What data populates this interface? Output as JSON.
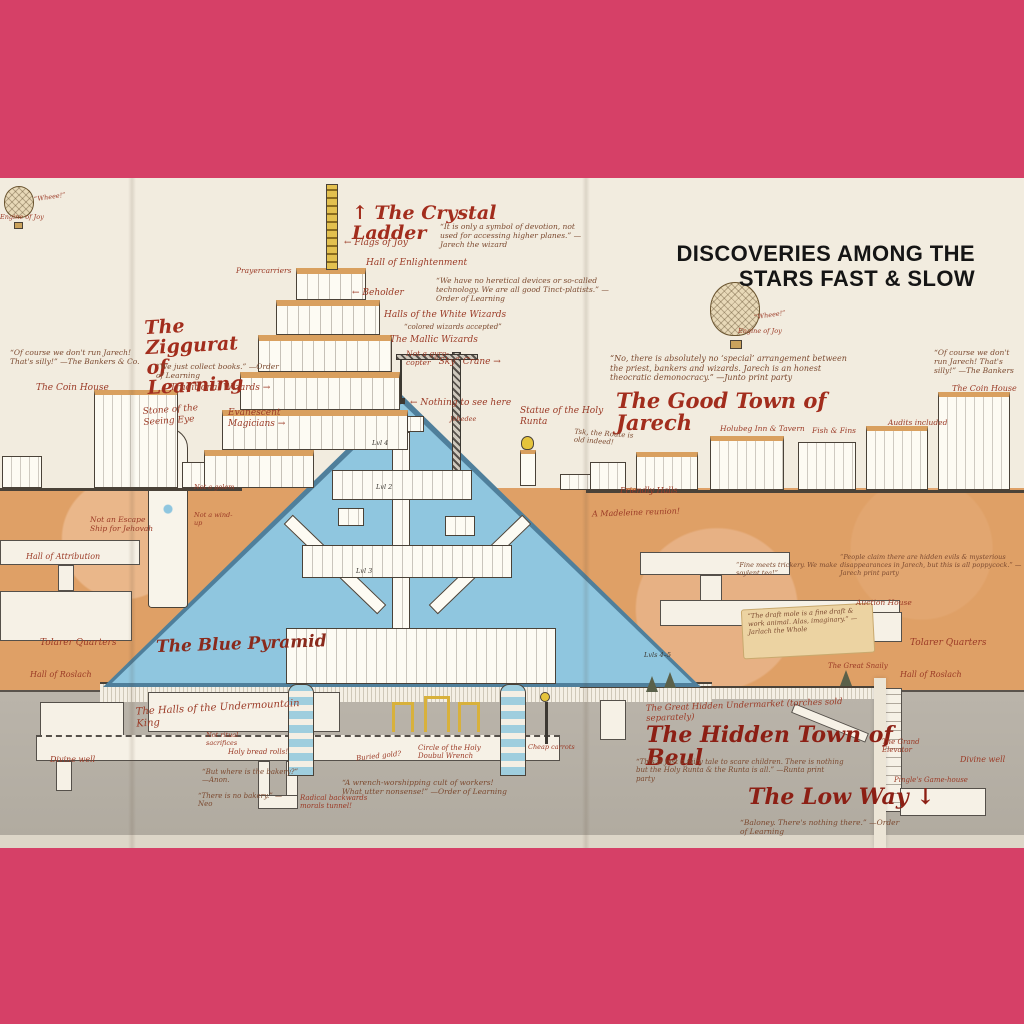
{
  "header": {
    "title": "DISCOVERIES AMONG THE STARS FAST & SLOW"
  },
  "palette": {
    "frame": "#d64067",
    "paper": "#f2ecdf",
    "earth": "#dfa066",
    "stone": "#b5afa5",
    "pyramid": "#8fc6df",
    "ink": "#9b3a26",
    "title_ink": "#a22d1d"
  },
  "labels": {
    "balloon_whee_left": "“Wheee!”",
    "balloon_engine_left": "Engine of Joy",
    "crystal_ladder": "↑ The Crystal Ladder",
    "flags_of_joy": "← Flags of Joy",
    "symbol_quote": "“It is only a symbol of devotion, not used for accessing higher planes.” —Jarech the wizard",
    "hall_enlightenment": "Hall of Enlightenment",
    "prayercarriers": "Prayercarriers",
    "beholder": "← Beholder",
    "heretical_quote": "“We have no heretical devices or so-called technology. We are all good Tinct-platists.” —Order of Learning",
    "white_wizards": "Halls of the White Wizards",
    "white_wizards_note": "“colored wizards accepted”",
    "mallic_wizards": "The Mallic Wizards",
    "not_gyrocopter": "Not a gyro-copter",
    "sky_crane": "“Sky” Crane →",
    "nothing_to_see": "← Nothing to see here",
    "jebedee": "Jebedee",
    "statue_runta": "Statue of the Holy Runta",
    "route_old": "Tsk, the Route is old indeed!",
    "ziggurat": "The Ziggurat of Learning",
    "collect_books": "“We just collect books.” —Order of Learning",
    "traditional_wizards": "Traditional Wizards →",
    "stone_eye": "Stone of the Seeing Eye",
    "evanescent_magicians": "Evanescent Magicians →",
    "bankers_left": "“Of course we don't run Jarech! That's silly!” —The Bankers & Co.",
    "coin_house_left": "The Coin House",
    "not_golem": "Not a golem",
    "not_windup": "Not a wind-up",
    "escape_ship": "Not an Escape Ship for Jehovah",
    "hall_attribution_left": "Hall of Attribution",
    "quarters_left": "Tolarer Quarters",
    "hall_roslach_left": "Hall of Roslach",
    "undermountain_king": "The Halls of the Undermountain King",
    "ritual_sacrifices": "Not ritual sacrifices",
    "divine_well_left": "Divine well",
    "holy_bread": "Holy bread rolls!",
    "bakery_question": "“But where is the bakery?” —Anon.",
    "bakery_answer": "“There is no bakery.” —Neo",
    "morals_tunnel": "Radical backwards morals tunnel!",
    "buried_gold": "Buried gold?",
    "circle_wrench": "Circle of the Holy Doubul Wrench",
    "wrench_quote": "“A wrench-worshipping cult of workers! What utter nonsense!” —Order of Learning",
    "cheap_carrots": "Cheap carrots",
    "blue_pyramid": "The Blue Pyramid",
    "lvl4": "Lvl 4",
    "lvl2": "Lvl 2",
    "lvl3": "Lvl 3",
    "lvls45": "Lvls 4–5",
    "balloon_whee_right": "“Wheee!”",
    "balloon_engine_right": "Engine of Joy",
    "arrangement_quote": "“No, there is absolutely no ‘special’ arrangement between the priest, bankers and wizards. Jarech is an honest theocratic demonocracy.” —Junto print party",
    "good_town": "The Good Town of Jarech",
    "holubeg_inn": "Holubeg Inn & Tavern",
    "fish_fins": "Fish & Fins",
    "audits_included": "Audits included",
    "bankers_right": "“Of course we don't run Jarech! That's silly!” —The Bankers",
    "coin_house_right": "The Coin House",
    "friendly_halls": "Friendly Halls",
    "madeleine_reunion": "A Madeleine reunion!",
    "soylent_quote": "“Fine meets trickery. We make soylent tea!”",
    "poppycock_quote": "“People claim there are hidden evils & mysterious disappearances in Jarech, but this is all poppycock.” —Jarech print party",
    "auction_house": "Auction House",
    "draft_mole_quote": "“The draft mole is a fine draft & work animal. Alas, imaginary.” —Jarlach the Whole",
    "great_snaily": "The Great Snaily",
    "quarters_right": "Tolarer Quarters",
    "hall_roslach_right": "Hall of Roslach",
    "undermarket": "The Great Hidden Undermarket (torches sold separately)",
    "hidden_town": "The Hidden Town of Beul",
    "fairy_tale_quote": "“This is just a fairy tale to scare children. There is nothing but the Holy Runta & the Runta is all.” —Runta print party",
    "low_way": "The Low Way ↓",
    "baloney_quote": "“Baloney. There's nothing there.” —Order of Learning",
    "grand_elevator": "The Grand Elevator",
    "pingles_gamehouse": "Pingle's Game-house",
    "divine_well_right": "Divine well"
  }
}
